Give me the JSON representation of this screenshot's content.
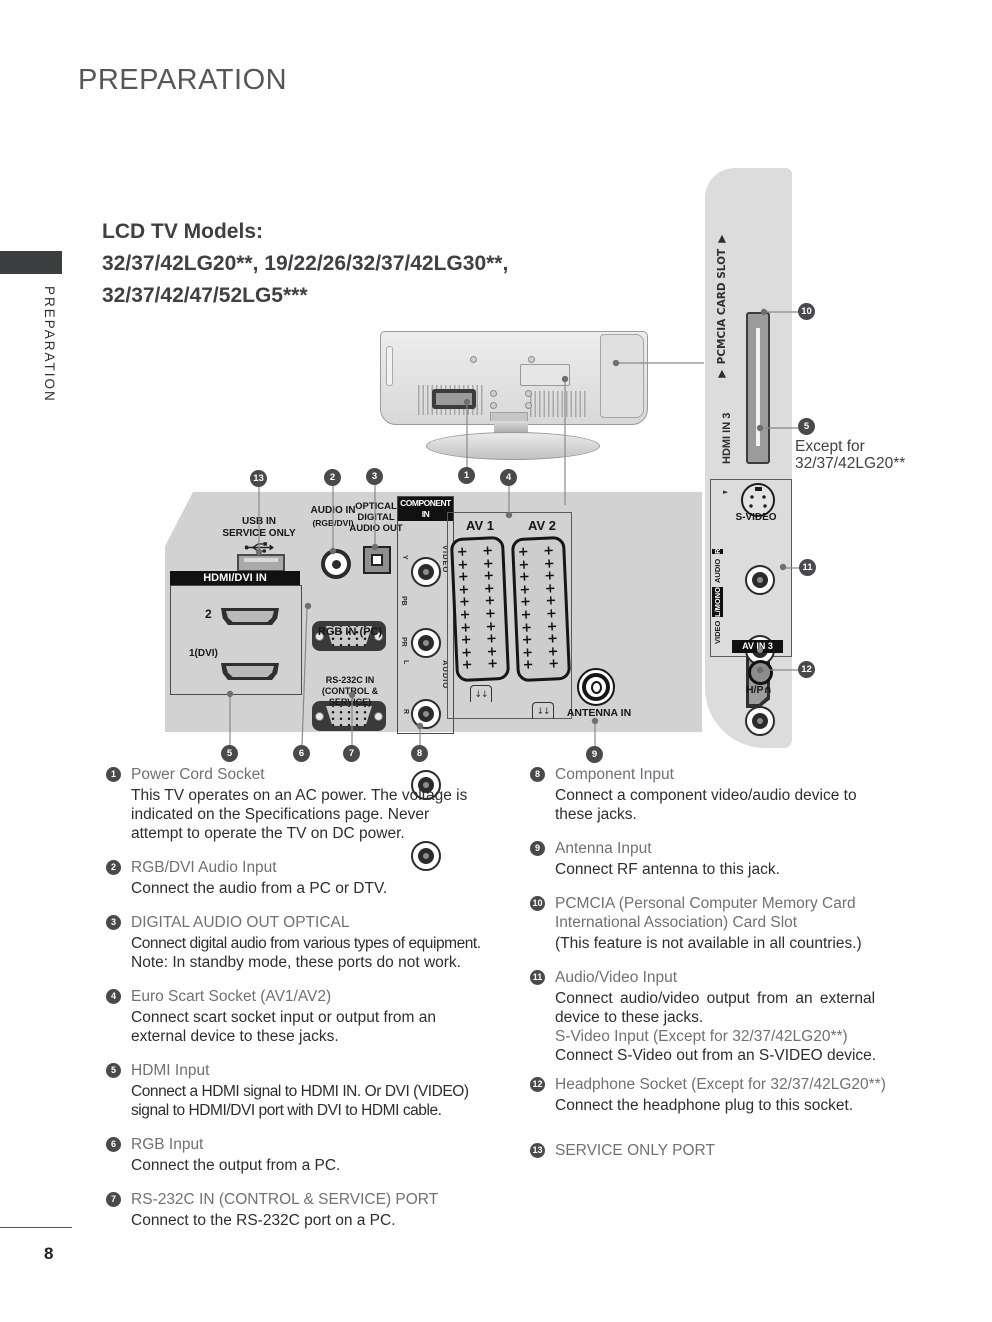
{
  "page": {
    "title": "PREPARATION",
    "sidebar_label": "PREPARATION",
    "page_number": "8",
    "models": {
      "heading": "LCD TV Models:",
      "line1": "32/37/42LG20**, 19/22/26/32/37/42LG30**,",
      "line2": "32/37/42/47/52LG5***"
    }
  },
  "back_panel": {
    "usb": {
      "line1": "USB IN",
      "line2": "SERVICE ONLY"
    },
    "hdmi_dvi": {
      "label": "HDMI/DVI IN",
      "port2": "2",
      "port1": "1(DVI)"
    },
    "audio_in": {
      "line1": "AUDIO IN",
      "line2": "(RGB/DVI)"
    },
    "optical": {
      "line1": "OPTICAL",
      "line2": "DIGITAL",
      "line3": "AUDIO OUT"
    },
    "rgb_in_label": "RGB IN (PC)",
    "rs232": {
      "line1": "RS-232C IN",
      "line2": "(CONTROL & SERVICE)"
    },
    "component": {
      "label_line1": "COMPONENT",
      "label_line2": "IN",
      "jack_labels": [
        "Y",
        "PB",
        "PR",
        "L",
        "R"
      ],
      "video_group": "VIDEO",
      "audio_group": "AUDIO"
    },
    "scart": {
      "av1": "AV 1",
      "av2": "AV 2"
    },
    "antenna_label": "ANTENNA IN"
  },
  "side_panel": {
    "pcmcia_label": "▼ PCMCIA CARD SLOT ▼",
    "hdmi3_label": "HDMI IN 3",
    "except_note": {
      "line1": "Except for",
      "line2": "32/37/42LG20**"
    },
    "svideo_label": "S-VIDEO",
    "svideo_arrow": "►",
    "av_labels": {
      "video": "VIDEO",
      "l_mono": "L/MONO",
      "audio": "AUDIO",
      "r": "R"
    },
    "av_in3_label": "AV IN 3",
    "headphone_label": "H/P",
    "headphone_icon": "∩"
  },
  "callouts": {
    "c1": "1",
    "c2": "2",
    "c3": "3",
    "c4": "4",
    "c5": "5",
    "c6": "6",
    "c7": "7",
    "c8": "8",
    "c9": "9",
    "c10": "10",
    "c11": "11",
    "c12": "12",
    "c13": "13"
  },
  "legend": {
    "left": [
      {
        "num": "1",
        "heading": "Power Cord Socket",
        "line1": "This TV operates on an AC power. The voltage is",
        "line2": "indicated on the Specifications page. Never",
        "line3": "attempt to operate the TV on DC power."
      },
      {
        "num": "2",
        "heading": "RGB/DVI Audio Input",
        "line1": "Connect the audio from a PC or DTV."
      },
      {
        "num": "3",
        "heading": "DIGITAL AUDIO OUT OPTICAL",
        "line1": "Connect digital audio from various types of equipment.",
        "line2": "Note: In standby mode, these ports do not work."
      },
      {
        "num": "4",
        "heading": "Euro Scart Socket (AV1/AV2)",
        "line1": "Connect scart socket input or output from an",
        "line2": "external device to these jacks."
      },
      {
        "num": "5",
        "heading": "HDMI Input",
        "line1": "Connect a HDMI signal to HDMI IN. Or DVI (VIDEO)",
        "line2": "signal to HDMI/DVI port with DVI to HDMI cable."
      },
      {
        "num": "6",
        "heading": "RGB Input",
        "line1": "Connect the output from a PC."
      },
      {
        "num": "7",
        "heading": "RS-232C IN (CONTROL & SERVICE) PORT",
        "line1": "Connect to the RS-232C port on a PC."
      }
    ],
    "right": [
      {
        "num": "8",
        "heading": "Component Input",
        "line1": "Connect a component video/audio device to",
        "line2": "these jacks."
      },
      {
        "num": "9",
        "heading": "Antenna Input",
        "line1": "Connect RF antenna to this jack."
      },
      {
        "num": "10",
        "heading": "PCMCIA (Personal Computer Memory Card",
        "heading2": "International Association) Card Slot",
        "line1": "(This feature is not available in all countries.)"
      },
      {
        "num": "11",
        "heading": "Audio/Video Input",
        "line1": "Connect audio/video output from an external",
        "line2": "device to these jacks.",
        "sub_heading": "S-Video Input (Except for 32/37/42LG20**)",
        "line3": "Connect S-Video out from an S-VIDEO device."
      },
      {
        "num": "12",
        "heading": "Headphone Socket (Except for 32/37/42LG20**)",
        "line1": "Connect the headphone plug to this socket."
      },
      {
        "num": "13",
        "heading": "SERVICE ONLY PORT"
      }
    ]
  }
}
